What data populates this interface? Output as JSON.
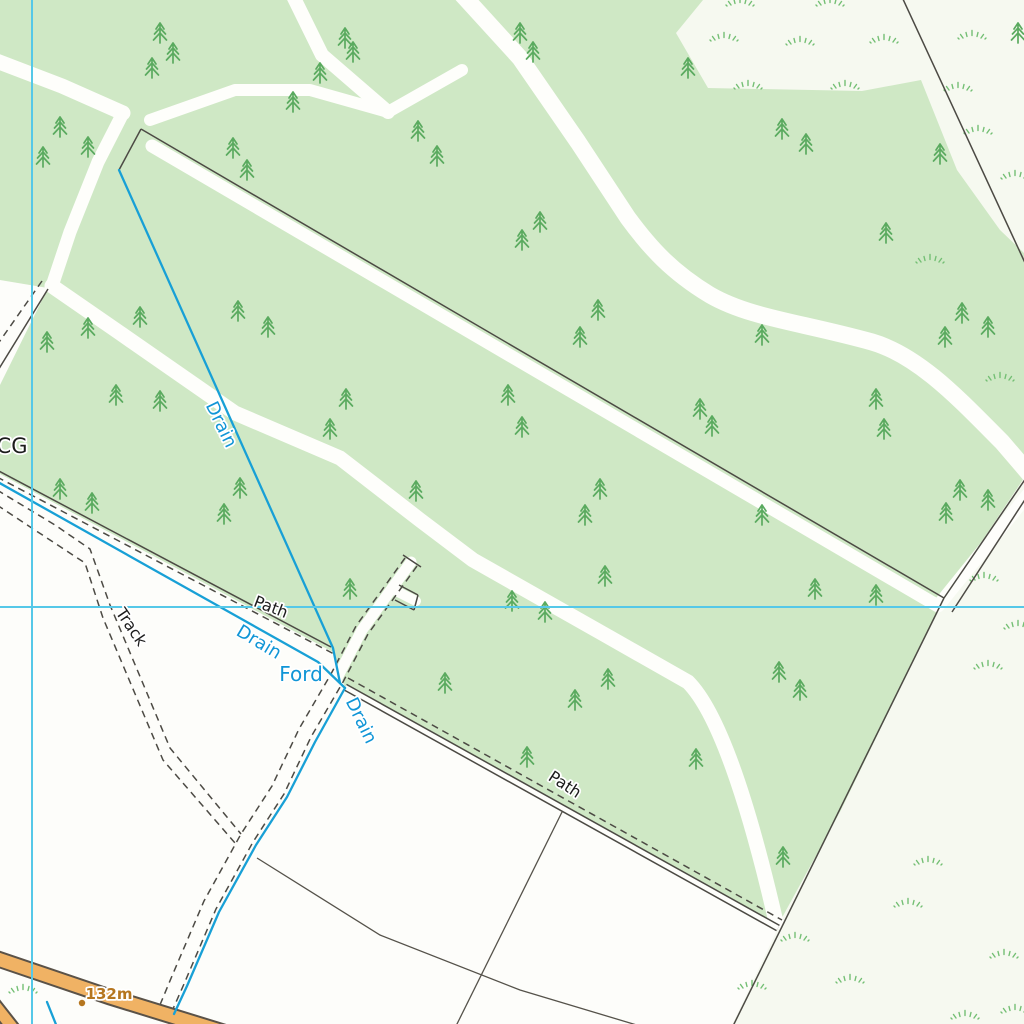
{
  "map": {
    "title": "Topographic map extract (woodland, drains and tracks)",
    "style": "ordnance-survey-raster",
    "colors": {
      "grass_background": "#f6f9f0",
      "field_background": "#fdfdfa",
      "woodland_fill": "#cfe8c5",
      "ride_white": "#fefefb",
      "grid_cyan": "#55c8e8",
      "drain_blue": "#18a0d6",
      "fence_grey": "#4c4a44",
      "field_boundary_grey": "#55524a",
      "road_orange": "#f0b264",
      "road_casing": "#5a5248",
      "conifer_green": "#5aaa5f",
      "rough_grass_green": "#74bf74",
      "water_label_blue": "#1095d6",
      "black_label": "#1c1c1c",
      "spot_height_orange": "#b5761f"
    },
    "grid": {
      "vertical_line_x": 32,
      "horizontal_line_y": 607
    },
    "labels": [
      {
        "id": "cg",
        "text": "CG",
        "x": 12,
        "y": 453,
        "rotate": 0,
        "size": 21,
        "kind": "black"
      },
      {
        "id": "drain-upper",
        "text": "Drain",
        "x": 216,
        "y": 427,
        "rotate": 64,
        "size": 18,
        "kind": "water"
      },
      {
        "id": "drain-edge",
        "text": "Drain",
        "x": 256,
        "y": 647,
        "rotate": 31,
        "size": 18,
        "kind": "water"
      },
      {
        "id": "ford",
        "text": "Ford",
        "x": 301,
        "y": 681,
        "rotate": 0,
        "size": 20,
        "kind": "water"
      },
      {
        "id": "drain-track",
        "text": "Drain",
        "x": 356,
        "y": 723,
        "rotate": 64,
        "size": 18,
        "kind": "water"
      },
      {
        "id": "path-west",
        "text": "Path",
        "x": 269,
        "y": 612,
        "rotate": 21,
        "size": 16,
        "kind": "black"
      },
      {
        "id": "path-east",
        "text": "Path",
        "x": 562,
        "y": 789,
        "rotate": 33,
        "size": 16,
        "kind": "black"
      },
      {
        "id": "track",
        "text": "Track",
        "x": 127,
        "y": 630,
        "rotate": 56,
        "size": 16,
        "kind": "black"
      },
      {
        "id": "spot-height",
        "text": "132m",
        "x": 109,
        "y": 999,
        "rotate": 0,
        "size": 15,
        "kind": "spot"
      }
    ],
    "spot_height": {
      "label": "132m",
      "dot_x": 82,
      "dot_y": 1003
    },
    "symbols": {
      "conifer_positions": [
        [
          160,
          33
        ],
        [
          173,
          53
        ],
        [
          152,
          68
        ],
        [
          293,
          102
        ],
        [
          60,
          127
        ],
        [
          88,
          147
        ],
        [
          43,
          157
        ],
        [
          233,
          148
        ],
        [
          247,
          170
        ],
        [
          345,
          38
        ],
        [
          353,
          52
        ],
        [
          520,
          33
        ],
        [
          533,
          52
        ],
        [
          320,
          73
        ],
        [
          688,
          68
        ],
        [
          418,
          131
        ],
        [
          437,
          156
        ],
        [
          540,
          222
        ],
        [
          522,
          240
        ],
        [
          598,
          310
        ],
        [
          580,
          337
        ],
        [
          782,
          129
        ],
        [
          806,
          144
        ],
        [
          940,
          154
        ],
        [
          886,
          233
        ],
        [
          1018,
          33
        ],
        [
          762,
          335
        ],
        [
          945,
          337
        ],
        [
          962,
          313
        ],
        [
          988,
          327
        ],
        [
          47,
          342
        ],
        [
          88,
          328
        ],
        [
          140,
          317
        ],
        [
          116,
          395
        ],
        [
          160,
          401
        ],
        [
          238,
          311
        ],
        [
          268,
          327
        ],
        [
          346,
          399
        ],
        [
          330,
          429
        ],
        [
          508,
          395
        ],
        [
          522,
          427
        ],
        [
          700,
          409
        ],
        [
          712,
          426
        ],
        [
          876,
          399
        ],
        [
          884,
          429
        ],
        [
          240,
          488
        ],
        [
          224,
          514
        ],
        [
          60,
          489
        ],
        [
          92,
          503
        ],
        [
          416,
          491
        ],
        [
          600,
          489
        ],
        [
          585,
          515
        ],
        [
          762,
          515
        ],
        [
          946,
          513
        ],
        [
          350,
          589
        ],
        [
          512,
          601
        ],
        [
          545,
          612
        ],
        [
          605,
          576
        ],
        [
          815,
          589
        ],
        [
          876,
          595
        ],
        [
          960,
          490
        ],
        [
          988,
          500
        ],
        [
          445,
          683
        ],
        [
          575,
          700
        ],
        [
          608,
          679
        ],
        [
          779,
          672
        ],
        [
          800,
          690
        ],
        [
          527,
          757
        ],
        [
          696,
          759
        ],
        [
          783,
          857
        ]
      ],
      "rough_grass_positions": [
        [
          740,
          5
        ],
        [
          830,
          5
        ],
        [
          724,
          40
        ],
        [
          800,
          44
        ],
        [
          884,
          42
        ],
        [
          972,
          38
        ],
        [
          748,
          88
        ],
        [
          845,
          88
        ],
        [
          958,
          90
        ],
        [
          978,
          133
        ],
        [
          1015,
          178
        ],
        [
          930,
          262
        ],
        [
          1000,
          380
        ],
        [
          984,
          580
        ],
        [
          1018,
          628
        ],
        [
          988,
          668
        ],
        [
          928,
          864
        ],
        [
          795,
          940
        ],
        [
          752,
          988
        ],
        [
          850,
          982
        ],
        [
          1004,
          957
        ],
        [
          1015,
          1012
        ],
        [
          908,
          906
        ],
        [
          965,
          1018
        ],
        [
          23,
          992
        ]
      ]
    },
    "features": {
      "woodland": "coniferous woodland parcel with internal rides",
      "drains": [
        "upper drain through wood",
        "drain along south-west wood edge",
        "drain beside track"
      ],
      "ford": "ford where drain crosses the track",
      "tracks": [
        "unfenced track with T-shaped turning head",
        "track from west joining main track"
      ],
      "paths": [
        "path along south-west wood edge",
        "path along south-east wood edge"
      ],
      "road": "minor orange road at bottom-left with spot height 132m",
      "field_boundaries": "thin boundary lines in fields at bottom"
    }
  }
}
